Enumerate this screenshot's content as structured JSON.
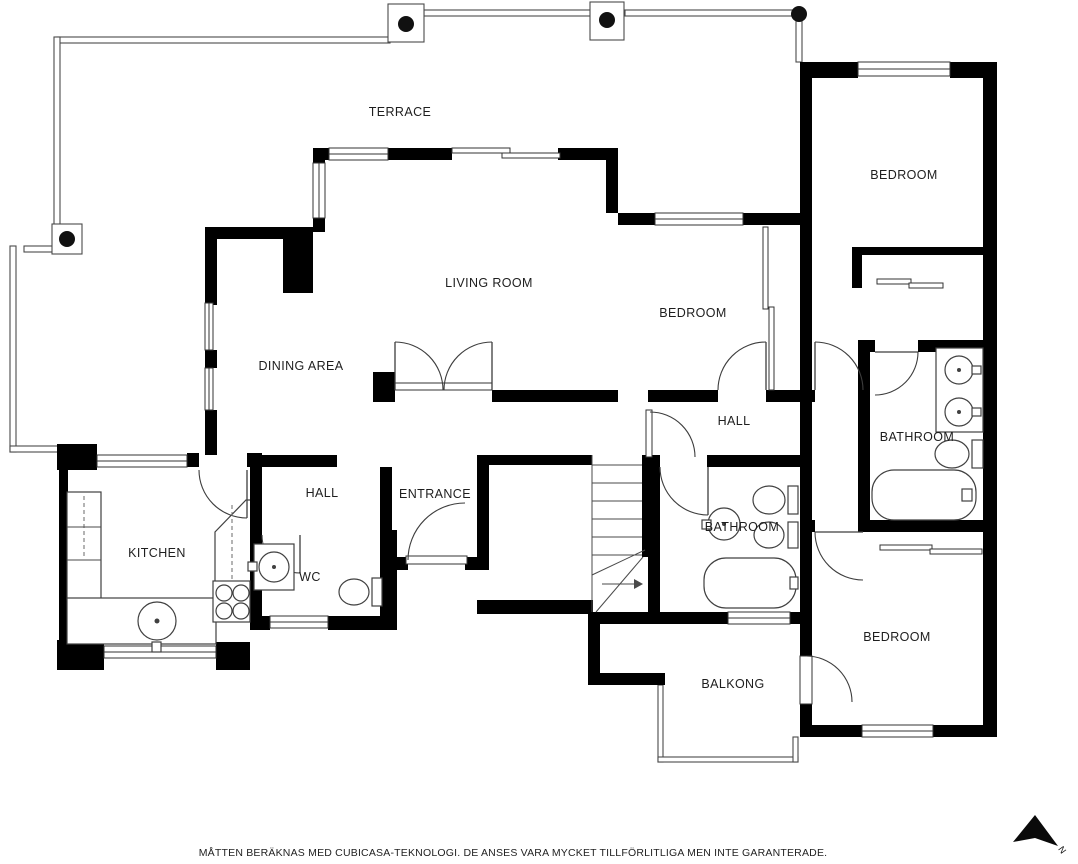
{
  "title": "Floor plan",
  "rooms": {
    "terrace": {
      "label": "TERRACE"
    },
    "living_room": {
      "label": "LIVING ROOM"
    },
    "dining_area": {
      "label": "DINING AREA"
    },
    "bedroom_top": {
      "label": "BEDROOM"
    },
    "bedroom_mid": {
      "label": "BEDROOM"
    },
    "bedroom_bottom": {
      "label": "BEDROOM"
    },
    "hall_upper": {
      "label": "HALL"
    },
    "hall_lower": {
      "label": "HALL"
    },
    "entrance": {
      "label": "ENTRANCE"
    },
    "kitchen": {
      "label": "KITCHEN"
    },
    "wc": {
      "label": "WC"
    },
    "bathroom_right": {
      "label": "BATHROOM"
    },
    "bathroom_mid": {
      "label": "BATHROOM"
    },
    "balcony": {
      "label": "BALKONG"
    }
  },
  "compass": {
    "label": "N"
  },
  "disclaimer": "MÅTTEN BERÄKNAS MED CUBICASA-TEKNOLOGI. DE ANSES VARA MYCKET TILLFÖRLITLIGA MEN INTE GARANTERADE.",
  "colors": {
    "wall": "#000000",
    "background": "#ffffff",
    "line": "#404040",
    "text": "#1e1e1e"
  }
}
